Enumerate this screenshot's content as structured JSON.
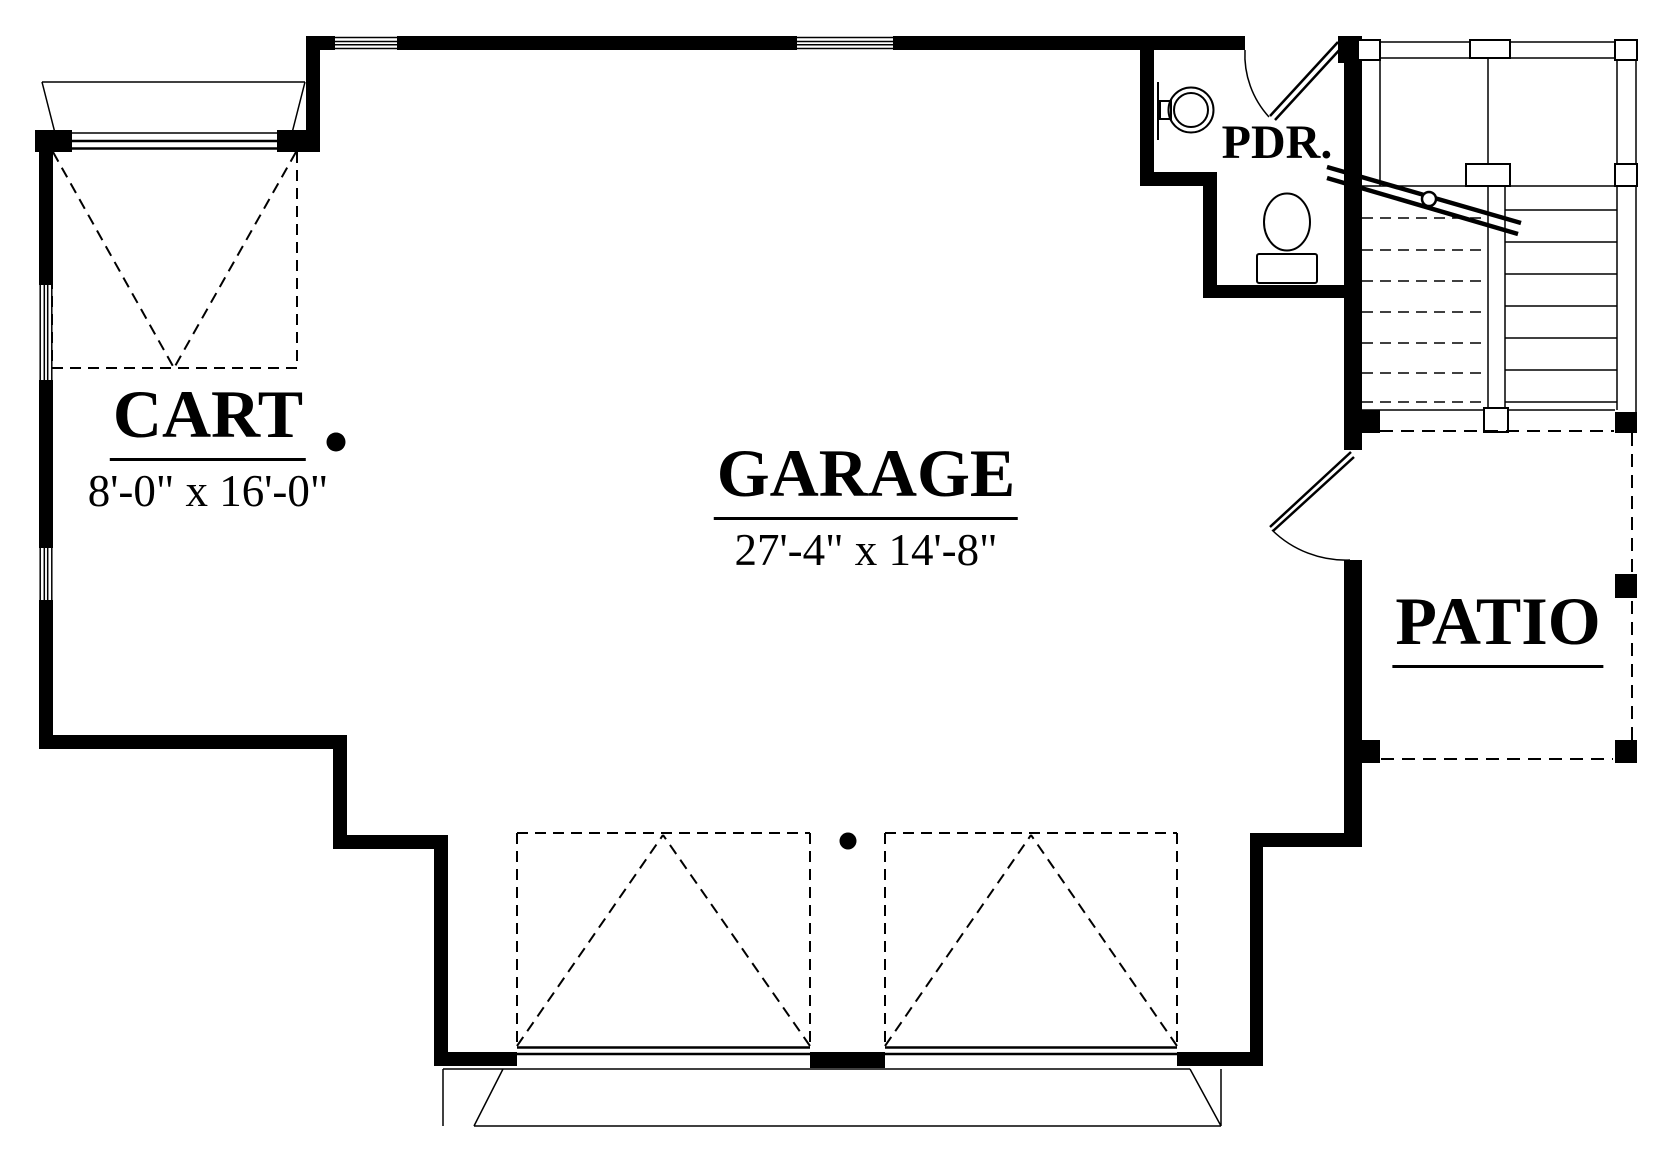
{
  "document": {
    "type": "architectural-floor-plan",
    "sheet": "garage-level"
  },
  "rooms": {
    "cart": {
      "label": "CART",
      "dims": "8'-0\" x 16'-0\""
    },
    "garage": {
      "label": "GARAGE",
      "dims": "27'-4\" x 14'-8\""
    },
    "pdr": {
      "label": "PDR."
    },
    "patio": {
      "label": "PATIO"
    }
  },
  "fixtures": [
    "round-sink",
    "toilet",
    "stairs",
    "handrail",
    "door-swings",
    "overhead-garage-doors"
  ],
  "colors": {
    "ink": "#000000",
    "paper": "#ffffff"
  }
}
